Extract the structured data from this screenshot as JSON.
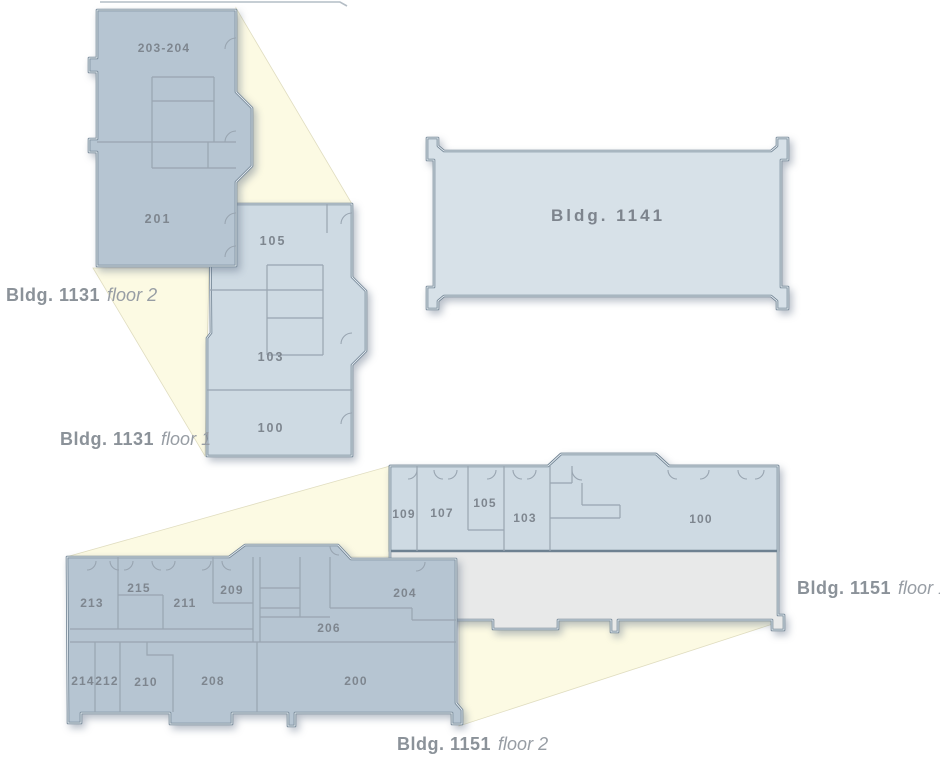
{
  "colors": {
    "floor2_fill": "#b6c5d2",
    "floor1_fill": "#cedae3",
    "bldg1141_fill": "#d7e1e8",
    "lower_level_fill": "#e8e9e9",
    "beam_fill": "#fcfae3",
    "room_text": "#7e868f",
    "label_text": "#8b9299"
  },
  "buildings": [
    {
      "id": "bldg-1131-floor-2",
      "name": "Bldg. 1131",
      "floor": "floor 2",
      "rooms": [
        "203-204",
        "201"
      ]
    },
    {
      "id": "bldg-1131-floor-1",
      "name": "Bldg. 1131",
      "floor": "floor 1",
      "rooms": [
        "105",
        "103",
        "100"
      ]
    },
    {
      "id": "bldg-1141",
      "name": "Bldg. 1141",
      "floor": "",
      "rooms": []
    },
    {
      "id": "bldg-1151-floor-1",
      "name": "Bldg. 1151",
      "floor": "floor 1",
      "rooms": [
        "109",
        "107",
        "105",
        "103",
        "100"
      ]
    },
    {
      "id": "bldg-1151-floor-2",
      "name": "Bldg. 1151",
      "floor": "floor 2",
      "rooms": [
        "213",
        "215",
        "211",
        "209",
        "204",
        "206",
        "214",
        "212",
        "210",
        "208",
        "200"
      ]
    }
  ]
}
